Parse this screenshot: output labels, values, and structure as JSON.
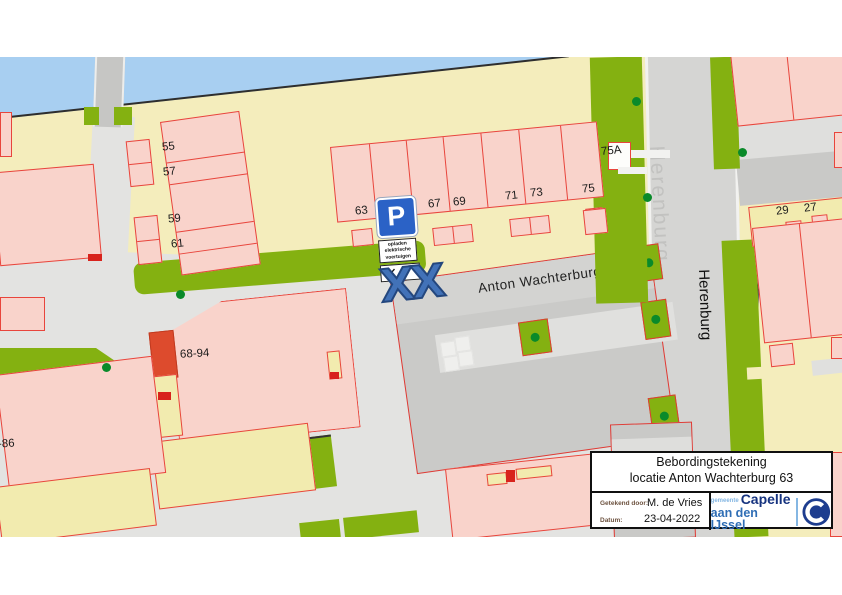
{
  "map": {
    "street_labels": {
      "anton_wachterburg": "Anton Wachterburg",
      "herenburg_big": "Herenburg",
      "herenburg_black": "Herenburg"
    },
    "house_labels": [
      {
        "text": "55",
        "x": 162,
        "y": 84,
        "rot": -6
      },
      {
        "text": "57",
        "x": 163,
        "y": 109,
        "rot": -6
      },
      {
        "text": "59",
        "x": 168,
        "y": 156,
        "rot": -6
      },
      {
        "text": "61",
        "x": 171,
        "y": 181,
        "rot": -6
      },
      {
        "text": "63",
        "x": 355,
        "y": 148,
        "rot": -6
      },
      {
        "text": "67",
        "x": 428,
        "y": 141,
        "rot": -6
      },
      {
        "text": "69",
        "x": 453,
        "y": 139,
        "rot": -6
      },
      {
        "text": "71",
        "x": 505,
        "y": 133,
        "rot": -6
      },
      {
        "text": "73",
        "x": 530,
        "y": 130,
        "rot": -6
      },
      {
        "text": "75",
        "x": 582,
        "y": 126,
        "rot": -6
      },
      {
        "text": "75A",
        "x": 601,
        "y": 88,
        "rot": -6
      },
      {
        "text": "29",
        "x": 776,
        "y": 148,
        "rot": -7
      },
      {
        "text": "27",
        "x": 804,
        "y": 145,
        "rot": -7
      },
      {
        "text": "68-94",
        "x": 180,
        "y": 291,
        "rot": -3
      },
      {
        "text": "-86",
        "x": -2,
        "y": 381,
        "rot": -3
      }
    ],
    "trees": [
      {
        "x": 176,
        "y": 233
      },
      {
        "x": 102,
        "y": 306
      },
      {
        "x": 632,
        "y": 40
      },
      {
        "x": 643,
        "y": 136
      },
      {
        "x": 738,
        "y": 91
      }
    ],
    "parking_sign": {
      "p_letter": "P",
      "subtext_lines": [
        "opladen",
        "elektrische",
        "voertuigen"
      ],
      "arrows": "↙↘"
    },
    "closure_marker": "XX"
  },
  "title_block": {
    "title_line1": "Bebordingstekening",
    "title_line2": "locatie Anton Wachterburg 63",
    "drawn_by_label": "Getekend door:",
    "drawn_by_value": "M. de Vries",
    "date_label": "Datum:",
    "date_value": "23-04-2022",
    "logo": {
      "gemeente": "gemeente",
      "name_line1": "Capelle",
      "name_line2": "aan den IJssel"
    }
  },
  "colors": {
    "water": "#A8CFF1",
    "land": "#F4EDBC",
    "building_pink": "#F9D3CB",
    "building_border_red": "#E8453C",
    "green_strip": "#84B111",
    "tree_dot": "#0A8A2A",
    "road_gray": "#D5D5D3",
    "parking_structure": "#CACAC8",
    "sign_blue": "#2B62C6",
    "closure_blue": "#4272B8",
    "logo_navy": "#16337F",
    "logo_blue": "#2F6EB5"
  }
}
